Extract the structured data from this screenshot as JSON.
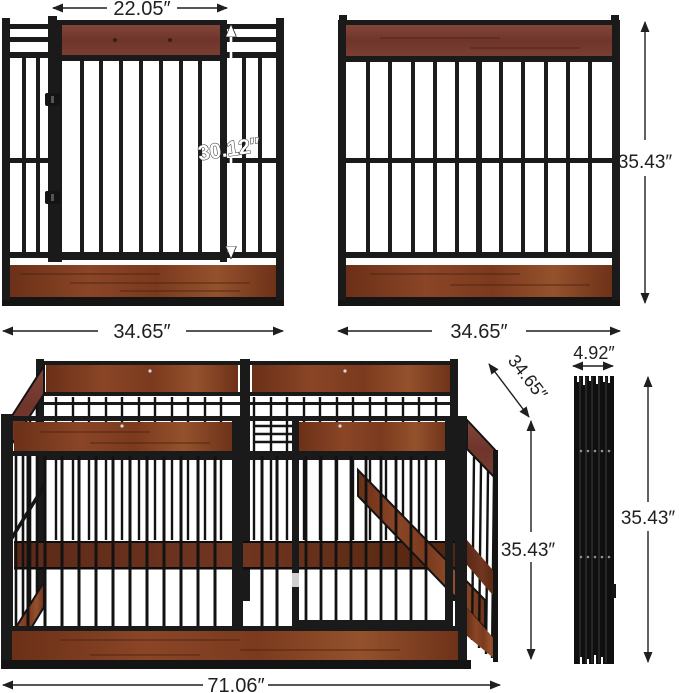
{
  "figure": {
    "kind": "product-dimension-diagram",
    "product": "wooden-frame dog playpen with gate",
    "views": {
      "gate_panel": "panel-with-gate-front-view",
      "side_panel": "plain-panel-front-view",
      "assembled": "assembled-playpen-3d-view",
      "folded": "folded-panels-side-view"
    }
  },
  "colors": {
    "dimension_line": "#1f1f1f",
    "metal_frame": "#1a1a1a",
    "wood_muted": "#7c4337",
    "wood_rich": "#84432a",
    "wood_dark": "#5e2a18",
    "background": "#ffffff"
  },
  "dimensions": {
    "gate_width": "22.05″",
    "gate_height": "30.12″",
    "gate_panel_width": "34.65″",
    "side_panel_height": "35.43″",
    "side_panel_width": "34.65″",
    "pen_depth": "34.65″",
    "pen_height": "35.43″",
    "pen_width": "71.06″",
    "folded_width": "4.92″",
    "folded_height": "35.43″"
  }
}
